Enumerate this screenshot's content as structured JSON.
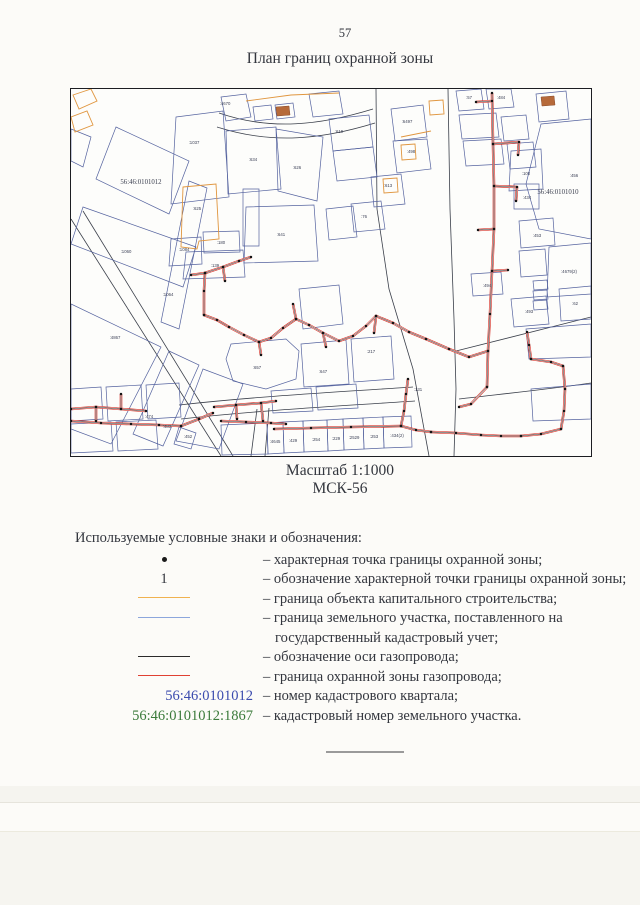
{
  "page": {
    "number": "57",
    "title": "План границ охранной зоны"
  },
  "caption": {
    "scale": "Масштаб 1:1000",
    "crs": "МСК-56"
  },
  "legend": {
    "heading": "Используемые условные знаки и обозначения:",
    "rows": [
      {
        "symbol_type": "dot",
        "symbol": "",
        "color": "#1a1a1a",
        "desc": "– характерная точка границы охранной зоны;"
      },
      {
        "symbol_type": "text",
        "symbol": "1",
        "color": "#33363e",
        "desc": "– обозначение характерной точки границы охранной зоны;"
      },
      {
        "symbol_type": "line",
        "symbol": "",
        "color": "#f0b24f",
        "desc": "– граница объекта капитального строительства;"
      },
      {
        "symbol_type": "line",
        "symbol": "",
        "color": "#8ca6dc",
        "desc": "– граница земельного участка, поставленного на государственный кадастровый учет;"
      },
      {
        "symbol_type": "line",
        "symbol": "",
        "color": "#2b2b2b",
        "desc": "– обозначение оси газопровода;"
      },
      {
        "symbol_type": "line",
        "symbol": "",
        "color": "#e04033",
        "desc": "– граница охранной зоны газопровода;"
      },
      {
        "symbol_type": "text-blue",
        "symbol": "56:46:0101012",
        "color": "#3b4bae",
        "desc": "– номер кадастрового квартала;"
      },
      {
        "symbol_type": "text-green",
        "symbol": "56:46:0101012:1867",
        "color": "#3a7a3a",
        "desc": "– кадастровый номер земельного участка."
      }
    ]
  },
  "map": {
    "colors": {
      "parcel": "#55639f",
      "road": "#3a3f4a",
      "building": "#e0963f",
      "fill": "#b66a3a",
      "pipeline_red": "#d8352b",
      "pipeline_axis": "#222222",
      "dot": "#141414",
      "label": "#3a3f55",
      "quarter": "#3c4050"
    },
    "quarter_labels": [
      {
        "x": 70,
        "y": 95,
        "t": "56:46:0101012"
      },
      {
        "x": 487,
        "y": 105,
        "t": "56:46:0101010"
      }
    ],
    "labels": [
      {
        "x": 154,
        "y": 16,
        "t": ":4670"
      },
      {
        "x": 123,
        "y": 55,
        "t": ":1037"
      },
      {
        "x": 182,
        "y": 72,
        "t": ":634"
      },
      {
        "x": 226,
        "y": 80,
        "t": ":626"
      },
      {
        "x": 126,
        "y": 121,
        "t": ":625"
      },
      {
        "x": 210,
        "y": 147,
        "t": ":641"
      },
      {
        "x": 150,
        "y": 155,
        "t": ":180"
      },
      {
        "x": 144,
        "y": 178,
        "t": ":139"
      },
      {
        "x": 113,
        "y": 162,
        "t": ":1084"
      },
      {
        "x": 55,
        "y": 164,
        "t": ":1060"
      },
      {
        "x": 97,
        "y": 207,
        "t": ":1064"
      },
      {
        "x": 44,
        "y": 250,
        "t": ":4867"
      },
      {
        "x": 78,
        "y": 329,
        "t": ":474"
      },
      {
        "x": 96,
        "y": 339,
        "t": ":483"
      },
      {
        "x": 117,
        "y": 349,
        "t": ":452"
      },
      {
        "x": 186,
        "y": 280,
        "t": ":657"
      },
      {
        "x": 252,
        "y": 284,
        "t": ":647"
      },
      {
        "x": 347,
        "y": 302,
        "t": ":131"
      },
      {
        "x": 204,
        "y": 354,
        "t": ":4645"
      },
      {
        "x": 222,
        "y": 353,
        "t": ":429"
      },
      {
        "x": 245,
        "y": 352,
        "t": ":254"
      },
      {
        "x": 265,
        "y": 351,
        "t": ":229"
      },
      {
        "x": 283,
        "y": 350,
        "t": ":2529"
      },
      {
        "x": 303,
        "y": 349,
        "t": ":253"
      },
      {
        "x": 326,
        "y": 348,
        "t": ":434(2)"
      },
      {
        "x": 398,
        "y": 10,
        "t": ":57"
      },
      {
        "x": 430,
        "y": 10,
        "t": ":484"
      },
      {
        "x": 455,
        "y": 86,
        "t": ":100"
      },
      {
        "x": 503,
        "y": 88,
        "t": ":456"
      },
      {
        "x": 456,
        "y": 110,
        "t": ":434"
      },
      {
        "x": 466,
        "y": 148,
        "t": ":453"
      },
      {
        "x": 498,
        "y": 184,
        "t": ":4679(2)"
      },
      {
        "x": 458,
        "y": 224,
        "t": ":493"
      },
      {
        "x": 416,
        "y": 198,
        "t": ":494"
      },
      {
        "x": 504,
        "y": 216,
        "t": ":62"
      },
      {
        "x": 336,
        "y": 34,
        "t": ":6497"
      },
      {
        "x": 340,
        "y": 64,
        "t": ":498"
      },
      {
        "x": 268,
        "y": 44,
        "t": ":619"
      },
      {
        "x": 317,
        "y": 98,
        "t": ":613"
      },
      {
        "x": 293,
        "y": 129,
        "t": ":76"
      },
      {
        "x": 300,
        "y": 264,
        "t": ":217"
      }
    ],
    "roads": [
      "M0,130 L150,367",
      "M12,122 L162,367",
      "M148,24 C200,42 250,36 302,20",
      "M146,38 C202,56 252,50 304,34",
      "M305,0 L306,120 L318,200 L342,280 L358,367",
      "M377,0 L379,120 L383,230 L385,300 L383,367",
      "M108,316 C180,308 250,304 342,298",
      "M110,330 C182,322 252,318 344,312",
      "M186,320 L180,367",
      "M198,319 L194,367",
      "M385,262 L520,228",
      "M388,310 C440,304 480,300 520,294"
    ],
    "parcels": [
      "45,38 118,72 98,125 25,90",
      "12,118 125,158 112,198 0,155",
      "118,92 136,99 108,240 90,233",
      "0,215 90,258 40,355 0,340",
      "98,262 128,276 92,357 62,345",
      "132,280 172,295 148,360 105,352",
      "108,338 125,344 120,360 103,355",
      "0,40 20,48 12,78 0,72",
      "105,28 152,22 158,108 100,115",
      "155,42 205,38 210,100 157,105",
      "205,40 252,48 246,112 207,102",
      "172,100 188,100 188,157 172,157",
      "175,118 243,116 247,172 173,174",
      "132,143 168,142 169,163 133,164",
      "115,163 172,161 174,188 112,190",
      "100,150 130,148 131,175 98,177",
      "160,255 215,250 228,262 225,290 195,300 162,292 155,270",
      "228,200 268,196 272,235 232,240",
      "150,8 175,5 180,28 155,32",
      "182,18 200,16 202,30 184,32",
      "204,16 222,14 224,28 206,30",
      "238,5 268,2 272,25 242,28",
      "320,20 352,16 356,48 324,52",
      "322,52 356,50 360,80 326,84",
      "300,88 330,85 334,115 303,118",
      "280,115 310,112 314,140 283,143",
      "255,120 282,117 286,148 258,151",
      "258,30 298,26 302,58 262,62",
      "262,62 302,58 306,88 266,92",
      "385,2 410,0 413,20 388,22",
      "415,0 440,0 443,18 418,20",
      "388,26 425,24 428,48 391,50",
      "392,52 430,50 433,75 395,77",
      "430,28 455,26 458,50 433,52",
      "436,55 462,53 465,78 439,80",
      "440,62 470,60 472,100 438,102",
      "465,5 495,2 498,30 468,33",
      "470,35 520,30 520,150 468,140 455,95",
      "443,95 468,95 468,120 443,120",
      "448,132 482,129 484,156 450,159",
      "478,158 520,154 520,205 476,208",
      "448,162 474,160 476,186 450,188",
      "440,210 475,207 478,235 443,238",
      "400,185 430,183 432,205 402,207",
      "462,192 476,191 477,200 463,201",
      "462,202 476,201 477,210 463,211",
      "462,212 476,211 477,220 463,221",
      "488,200 520,197 520,230 490,232",
      "455,240 520,235 520,268 458,270",
      "460,300 520,295 520,330 462,332",
      "196,334 212,333 213,364 197,365",
      "212,333 232,332 233,363 213,364",
      "232,332 256,331 257,362 233,363",
      "256,331 272,330 273,361 257,362",
      "272,330 292,329 293,360 273,361",
      "292,329 312,328 313,359 293,360",
      "312,328 340,327 341,358 313,359",
      "150,336 196,334 197,365 151,366",
      "0,300 30,298 32,330 0,332",
      "35,298 70,296 72,330 37,332",
      "75,296 108,294 110,328 77,330",
      "0,335 40,333 42,362 0,364",
      "45,333 85,331 87,360 47,362",
      "230,255 275,251 278,295 233,298",
      "280,250 320,247 323,290 283,293",
      "200,302 240,299 242,322 202,324",
      "245,298 285,295 287,319 247,321"
    ],
    "buildings": [
      "2,6 20,0 26,12 8,20",
      "0,28 16,22 22,36 4,43",
      "112,98 145,95 148,150 128,152 126,160 110,158",
      "330,56 344,55 345,70 331,71",
      "312,90 326,89 327,103 313,104",
      "358,12 372,11 373,25 359,26"
    ],
    "building_lines": [
      "175,12 220,6 268,4",
      "330,48 360,42"
    ],
    "fills": [
      "470,8 483,7 484,16 471,17",
      "205,18 218,17 219,26 206,27"
    ],
    "pipelines": [
      "421,4 422,55 423,97 423,140 421,182 419,225 417,262 416,298",
      "421,12 405,13",
      "422,55 448,53 447,66",
      "423,97 446,98 445,112",
      "423,140 407,141",
      "421,182 437,181",
      "417,262 398,268 378,260 355,250 338,243 322,234 305,227 295,237 282,247 268,252 252,244 238,236 225,230 212,239 200,249 188,253 173,246 158,238 146,231 133,226",
      "305,227 303,244",
      "252,244 255,258",
      "225,230 222,215",
      "188,253 190,266",
      "133,226 133,202 134,184",
      "134,184 120,186",
      "134,184 152,178 168,172 180,168",
      "152,178 154,192",
      "0,320 25,318 50,320 75,322",
      "25,318 25,332",
      "50,320 50,305",
      "0,332 30,334 60,335 88,336 110,337",
      "110,337 128,330 142,324",
      "143,318 165,316 190,314 205,312",
      "165,316 166,330",
      "190,314 192,332",
      "150,332 175,333 200,334 215,335",
      "203,340 240,339 280,338 330,337",
      "330,337 333,322 335,305 337,290",
      "330,337 345,341 360,343",
      "416,298 400,315 388,318",
      "460,270 480,273 492,277",
      "492,277 494,300 493,322 490,340",
      "490,340 470,345 450,347",
      "450,347 430,347 410,346 385,344 360,343",
      "460,270 458,256 456,243"
    ]
  }
}
